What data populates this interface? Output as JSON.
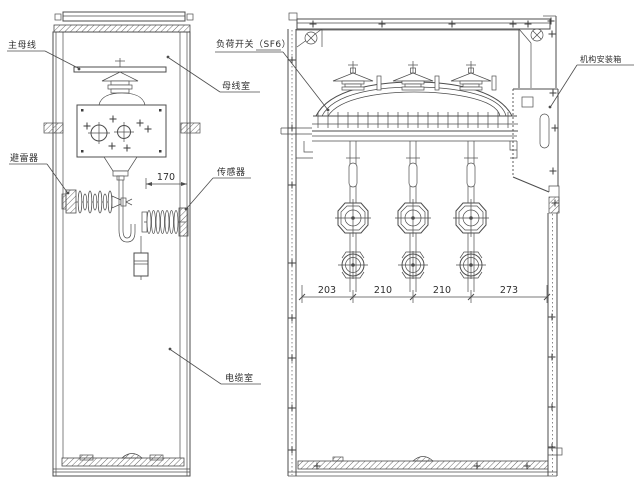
{
  "colors": {
    "line": "#4d4d4d",
    "background": "#ffffff",
    "text": "#2f2f2f"
  },
  "side_view": {
    "labels": {
      "main_busbar": "主母线",
      "busbar_compartment": "母线室",
      "arrester": "避雷器",
      "sensor": "传感器",
      "cable_compartment": "电缆室"
    },
    "dimensions": {
      "funnel_to_wall": "170"
    }
  },
  "front_view": {
    "labels": {
      "load_switch": "负荷开关（SF6）",
      "mechanism_box": "机构安装箱"
    },
    "dimensions": {
      "phase_spacing": [
        "203",
        "210",
        "210",
        "273"
      ]
    }
  }
}
